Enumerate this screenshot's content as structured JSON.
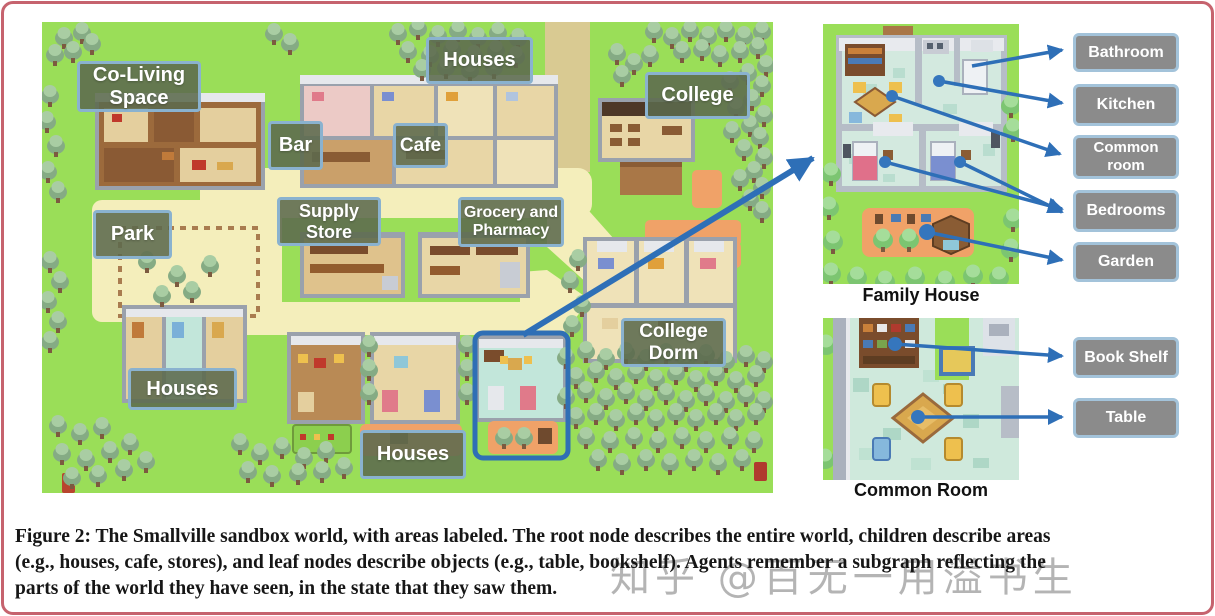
{
  "figure": {
    "map_labels": [
      {
        "id": "co-living-space",
        "text": "Co-Living Space"
      },
      {
        "id": "houses-north",
        "text": "Houses"
      },
      {
        "id": "college",
        "text": "College"
      },
      {
        "id": "bar",
        "text": "Bar"
      },
      {
        "id": "cafe",
        "text": "Cafe"
      },
      {
        "id": "supply-store",
        "text": "Supply Store"
      },
      {
        "id": "grocery-and-pharmacy",
        "text": "Grocery and Pharmacy"
      },
      {
        "id": "park",
        "text": "Park"
      },
      {
        "id": "college-dorm",
        "text": "College Dorm"
      },
      {
        "id": "houses-west",
        "text": "Houses"
      },
      {
        "id": "houses-south",
        "text": "Houses"
      }
    ],
    "family_house": {
      "caption": "Family House",
      "labels": [
        {
          "text": "Bathroom"
        },
        {
          "text": "Kitchen"
        },
        {
          "text": "Common room"
        },
        {
          "text": "Bedrooms"
        },
        {
          "text": "Garden"
        }
      ]
    },
    "common_room": {
      "caption": "Common Room",
      "labels": [
        {
          "text": "Book Shelf"
        },
        {
          "text": "Table"
        }
      ]
    },
    "caption_lines": [
      "Figure 2: The Smallville sandbox world, with areas labeled. The root node describes the entire world, children describe areas",
      "(e.g., houses, cafe, stores), and leaf nodes describe objects (e.g., table, bookshelf). Agents remember a subgraph reflecting the",
      "parts of the world they have seen, in the state that they saw them."
    ],
    "watermark": "知乎 @百无一用溢书生",
    "colors": {
      "arrow_blue": "#2e6fb7",
      "highlight_blue": "#2f6fb5",
      "area_label_green": "#5c6a4d",
      "label_border_blue": "#8ab2cf",
      "object_label_gray": "#8b8b8b",
      "frame_pink": "#c6636e",
      "grass_green": "#9ade58",
      "path_yellow": "#f4eebb",
      "road_beige": "#d9ca92",
      "garden_orange": "#f0a268"
    }
  }
}
